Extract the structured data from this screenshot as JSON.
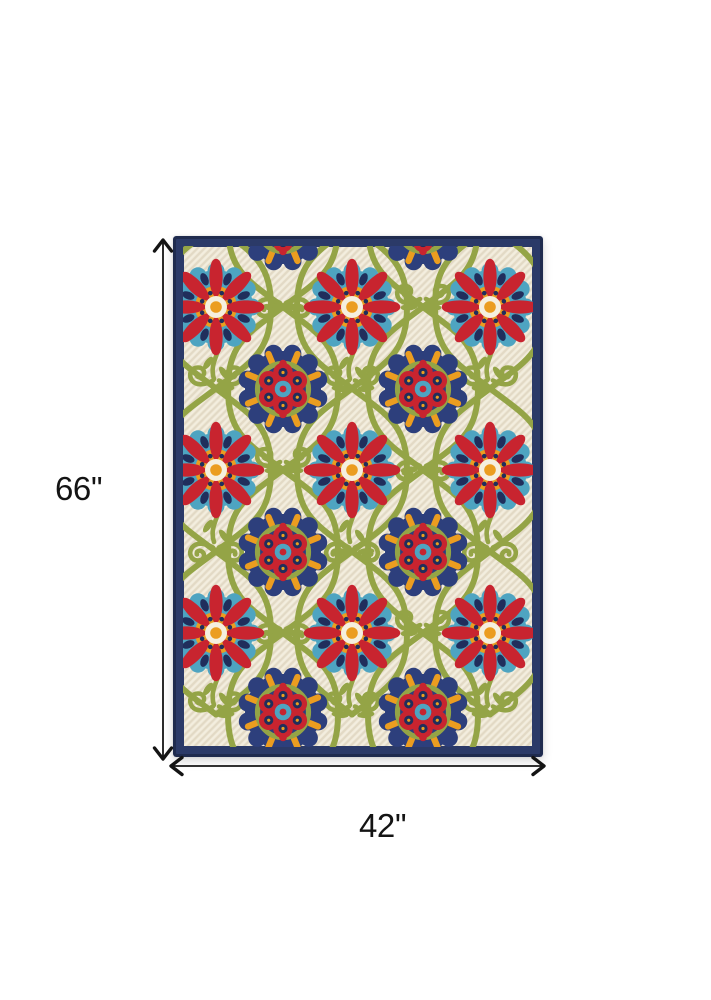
{
  "diagram": {
    "type": "product-dimension-diagram",
    "product": "multicolor floral medallion indoor-outdoor area rug",
    "height": {
      "label": "66''"
    },
    "width": {
      "label": "42''"
    },
    "line_color": "#141414"
  },
  "rug": {
    "colors": {
      "cream": "#efe8d5",
      "creamHi": "#f5efde",
      "navyBorder": "#2b3a68",
      "navyBorderEdge": "#1f2b4e",
      "navyMotif": "#2d3f7c",
      "navyDeep": "#202e5c",
      "green": "#94a446",
      "greenDark": "#7c8c39",
      "red": "#c8242f",
      "teal": "#4ea4c1",
      "orange": "#eb9d20"
    },
    "pattern": {
      "red_flower_cols": [
        43,
        179,
        317
      ],
      "red_flower_rows": [
        71,
        234,
        397
      ],
      "navy_medallion_cols": [
        110,
        250
      ],
      "navy_medallion_rows": [
        -10,
        153,
        316,
        476
      ],
      "vine_amplitude": 55
    }
  }
}
